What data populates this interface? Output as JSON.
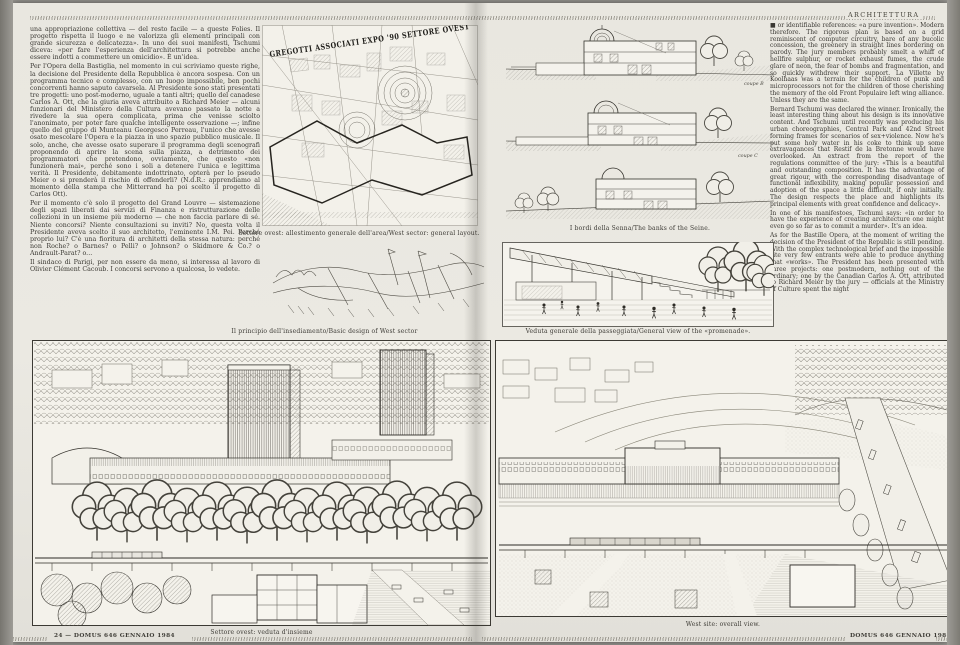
{
  "page": {
    "section_header": "ARCHITETTURA",
    "footer_left": "24 — DOMUS 646 GENNAIO 1984",
    "footer_right": "DOMUS 646 GENNAIO 1984 — 25"
  },
  "colors": {
    "paper": "#eae8e1",
    "ink": "#3a3833",
    "line": "#4a4841"
  },
  "left_column": {
    "language": "Italian",
    "paragraphs": [
      "una appropriazione collettiva — del resto facile — a queste Folies. Il progetto rispetta il luogo e ne valorizza gli elementi principali con grande sicurezza e delicatezza». In uno dei suoi manifesti, Tschumi diceva: «per fare l'esperienza dell'architettura si potrebbe anche essere indotti a commettere un omicidio». È un'idea.",
      "Per l'Opera della Bastiglia, nel momento in cui scriviamo queste righe, la decisione del Presidente della Repubblica è ancora sospesa. Con un programma tecnico e complesso, con un luogo impossibile, ben pochi concorrenti hanno saputo cavarsela. Al Presidente sono stati presentati tre progetti: uno post-moderno, uguale a tanti altri; quello del canadese Carlos A. Ott, che la giuria aveva attribuito a Richard Meier — alcuni funzionari del Ministero della Cultura avevano passato la notte a rivedere la sua opera complicata, prima che venisse sciolto l'anonimato, per poter fare qualche intelligente osservazione —; infine quello del gruppo di Munteanu Georgesco Perreau, l'unico che avesse osato mescolare l'Opera e la piazza in uno spazio pubblico musicale. Il solo, anche, che avesse osato superare il programma degli scenografi proponendo di aprire la scena sulla piazza, a detrimento dei programmatori che pretendono, ovviamente, che questo «non funzionerà mai», perché sono i soli a detenere l'unica e legittima verità. Il Presidente, debitamente indottrinato, opterà per lo pseudo Meier o si prenderà il rischio di offenderli? (N.d.R.: apprendiamo al momento della stampa che Mitterrand ha poi scelto il progetto di Carlos Ott).",
      "Per il momento c'è solo il progetto del Grand Louvre — sistemazione degli spazi liberati dai servizi di Finanza e ristrutturazione delle collezioni in un insieme più moderno — che non faccia parlare di sé. Niente concorsi? Niente consultazioni su inviti? No, questa volta il Presidente aveva scelto il suo architetto, l'eminente I.M. Pei. Perché proprio lui? C'è una fioritura di architetti della stessa natura: perché non Roche? o Barnes? o Pelli? o Johnson? o Skidmore & Co.? o Andrault-Parat? o...",
      "Il sindaco di Parigi, per non essere da meno, si interessa al lavoro di Olivier Clément Cacoub. I concorsi servono a qualcosa, lo vedete."
    ]
  },
  "right_column": {
    "language": "English",
    "paragraphs": [
      "■ or identifiable references: «a pure invention». Modern therefore. The rigorous plan is based on a grid reminiscent of computer circuitry, bare of any bucolic concession, the greenery in straight lines bordering on parody. The jury members probably smelt a whiff of hellfire sulphur, or rocket exhaust fumes, the crude glare of neon, the fear of bombs and fragmentation, and so quickly withdrew their support. La Villette by Koolhaas was a terrain for the children of punk and microprocessors not for the children of those cherishing the memory of the old Front Populaire left wing alliance. Unless they are the same.",
      "Bernard Tschumi was declared the winner. Ironically, the least interesting thing about his design is its innovative content. And Tschumi until recently was producing his urban choreographies, Central Park and 42nd Street forming frames for scenarios of sex+violence. Now he's put some holy water in his coke to think up some extravagances that Restif de la Bretonne would have overlooked. An extract from the report of the regulations committee of the jury: «This is a beautiful and outstanding composition. It has the advantage of great rigour, with the corresponding disadvantage of functional inflexibility, making popular possession and adoption of the space a little difficult, if only initially. The design respects the place and highlights its principal elements with great confidence and delicacy».",
      "In one of his manifestoes, Tschumi says: «in order to have the experience of creating architecture one might even go so far as to commit a murder». It's an idea.",
      "As for the Bastille Opera, at the moment of writing the decision of the President of the Republic is still pending. With the complex technological brief and the impossible site very few entrants were able to produce anything that «works». The President has been presented with three projects: one postmodern, nothing out of the ordinary; one by the Canadian Carlos A. Ott, attributed to Richard Meier by the jury — officials at the Ministry of Culture spent the night"
    ]
  },
  "figures": {
    "map": {
      "banner": "GREGOTTI ASSOCIATI EXPO '90 SETTORE OVEST",
      "caption": "Settore ovest: allestimento generale dell'area/West sector: general layout."
    },
    "sketch": {
      "caption": "Il principio dell'insediamento/Basic design of West sector"
    },
    "sections": {
      "caption": "I bordi della Senna/The banks of the Seine.",
      "labels": [
        "coupe B",
        "coupe C"
      ]
    },
    "promenade": {
      "caption": "Veduta generale della passeggiata/General view of the «promenade»."
    },
    "panorama_left": {
      "caption": "Settore ovest: veduta d'insieme"
    },
    "panorama_right": {
      "caption": "West site: overall view."
    }
  }
}
